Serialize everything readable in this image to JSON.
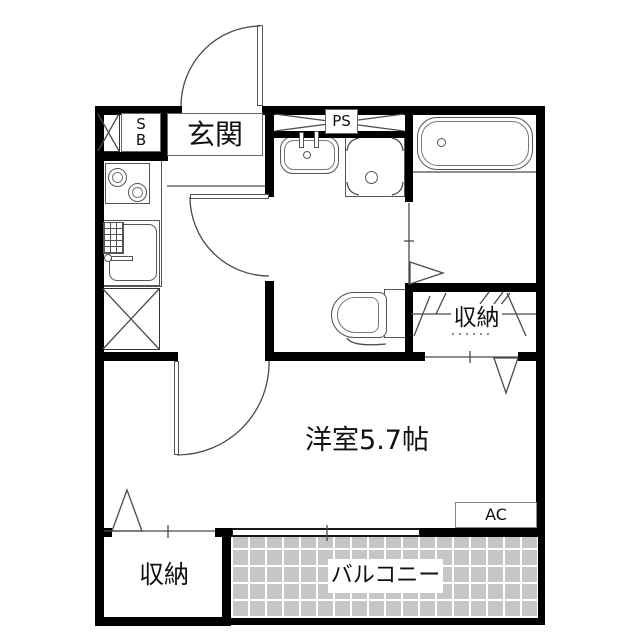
{
  "floorplan": {
    "labels": {
      "entrance": "玄関",
      "shoe_box_top": "S",
      "shoe_box_bottom": "B",
      "pipe_space": "PS",
      "closet_right": "収納",
      "closet_bottom": "収納",
      "main_room": "洋室5.7帖",
      "air_conditioner": "AC",
      "balcony": "バルコニー"
    },
    "colors": {
      "wall": "#000000",
      "line": "#4a4a4a",
      "balcony_tile": "#c6c6c6",
      "background": "#ffffff"
    }
  }
}
